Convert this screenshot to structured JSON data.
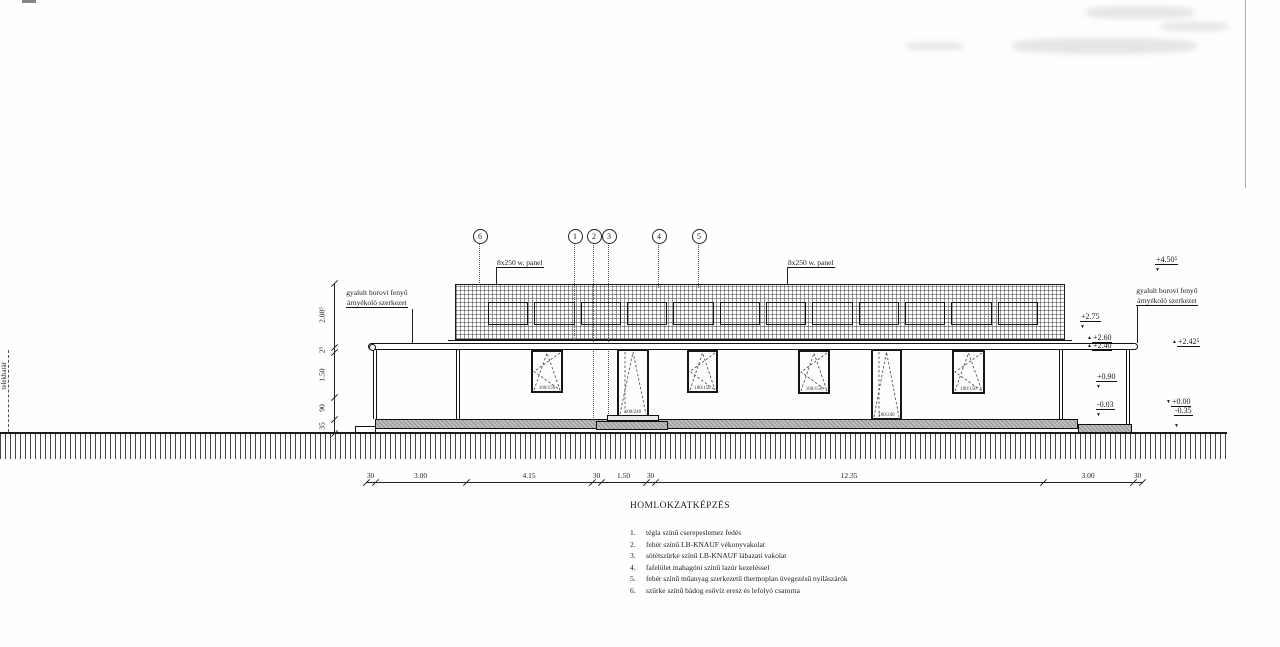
{
  "title": "HOMLOKZATKÉPZÉS",
  "legend": [
    {
      "num": "1.",
      "text": "tégla színű cserepeslemez fedés"
    },
    {
      "num": "2.",
      "text": "fehér színű LB-KNAUF vékonyvakolat"
    },
    {
      "num": "3.",
      "text": "sötétszürke színű LB-KNAUF lábazati vakolat"
    },
    {
      "num": "4.",
      "text": "fafelület mahagóni színű lazúr kezeléssel"
    },
    {
      "num": "5.",
      "text": "fehér színű műanyag szerkezetű thermoplan üvegezésű nyílászárók"
    },
    {
      "num": "6.",
      "text": "szürke színű bádog esővíz eresz és lefolyó csatorna"
    }
  ],
  "annotations": {
    "shade_left_line1": "gyalult borovi fenyő",
    "shade_left_line2": "árnyékoló szerkezet",
    "shade_right_line1": "gyalult borovi fenyő",
    "shade_right_line2": "árnyékoló szerkezet",
    "panel_label_left": "8x250 w. panel",
    "panel_label_right": "8x250 w. panel",
    "site_boundary": "telekhatár"
  },
  "bubbles": [
    {
      "n": "6"
    },
    {
      "n": "1"
    },
    {
      "n": "2"
    },
    {
      "n": "3"
    },
    {
      "n": "4"
    },
    {
      "n": "5"
    }
  ],
  "levels": {
    "plus450": "+4.50⁵",
    "plus275": "+2.75",
    "plus260": "+2.60",
    "plus240": "+2.40",
    "plus242": "+2.42⁵",
    "plus090": "+0.90",
    "minus003": "-0.03",
    "plus000": "+0.00",
    "minus035": "-0.35"
  },
  "dims": {
    "vertical": [
      "2.08⁵",
      "2⁵",
      "1.50",
      "90",
      "35"
    ],
    "horizontal": [
      "30",
      "3.00",
      "4.15",
      "30",
      "1.50",
      "30",
      "12.35",
      "3.00",
      "30"
    ]
  },
  "openings": [
    {
      "kind": "window",
      "label": "100/150"
    },
    {
      "kind": "door",
      "label": "100/240"
    },
    {
      "kind": "window",
      "label": "100/150"
    },
    {
      "kind": "window",
      "label": "100/150"
    },
    {
      "kind": "door",
      "label": "100/240"
    },
    {
      "kind": "window",
      "label": "100/150"
    }
  ],
  "colors": {
    "ink": "#1c1c1c",
    "plinth_gray": "#bdbdbd"
  }
}
